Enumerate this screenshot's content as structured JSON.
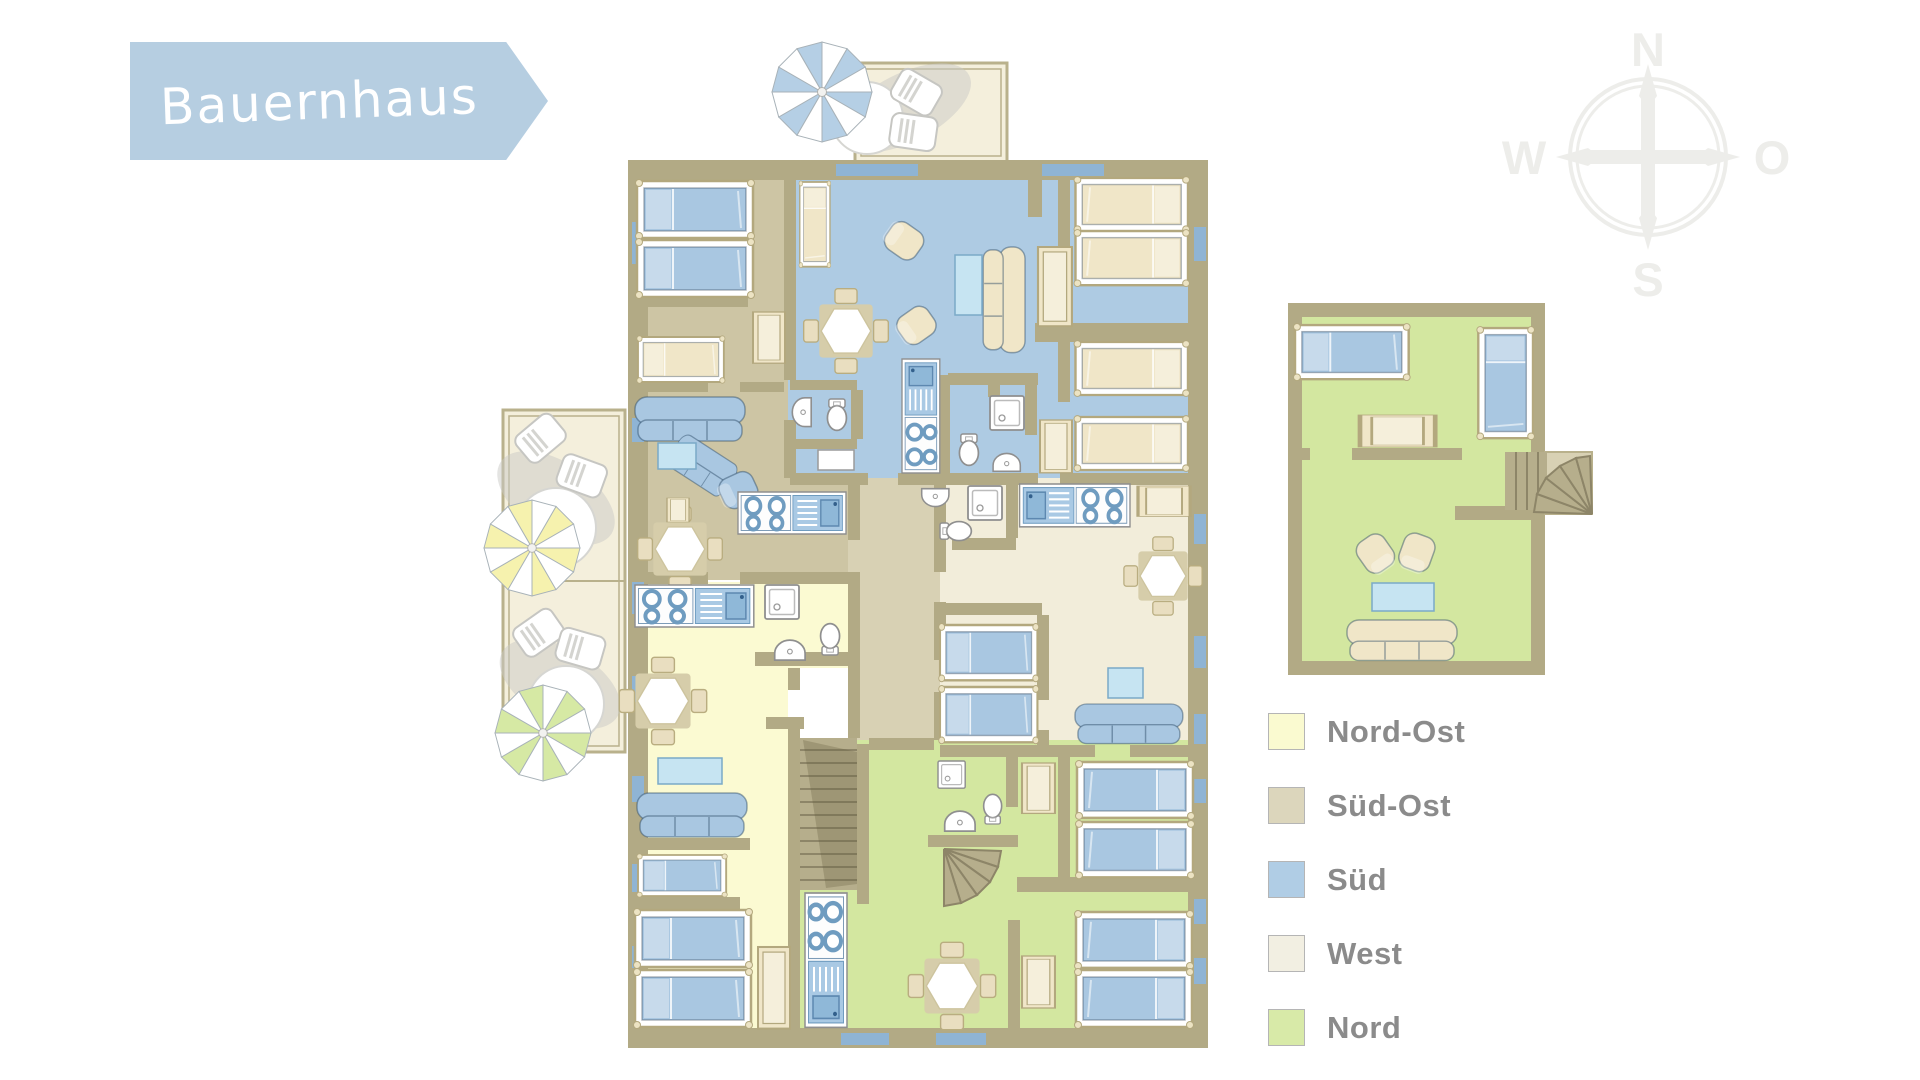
{
  "banner": {
    "title": "Bauernhaus"
  },
  "compass": {
    "north": "N",
    "east": "O",
    "south": "S",
    "west": "W"
  },
  "legend": {
    "items": [
      {
        "label": "Nord-Ost",
        "color": "#fafad0"
      },
      {
        "label": "Süd-Ost",
        "color": "#dcd6bc"
      },
      {
        "label": "Süd",
        "color": "#b0cde5"
      },
      {
        "label": "West",
        "color": "#f2efe2"
      },
      {
        "label": "Nord",
        "color": "#d8eaa8"
      }
    ]
  },
  "plan": {
    "colors": {
      "banner": "#b6cee1",
      "wall": "#b2aa85",
      "window": "#8fb4d4",
      "nordost": "#fbfad2",
      "suedost": "#cdc5a4",
      "sued": "#aecbe3",
      "west": "#f2edda",
      "nord": "#d3e7a0",
      "corridor": "#d8d1b4",
      "terrace": "#f4efdc",
      "terrace_border": "#b9b18c",
      "furn_blue": "#a9c7e1",
      "furn_cream": "#f0e6c8",
      "tv": "#c6e4f2",
      "stairs": "#b6ae8c",
      "stairs_line": "#8d8568",
      "shadow": "#c9c9c6",
      "compass": "#ededea",
      "umbrella_blue": "#b5cfe5",
      "umbrella_yellow": "#f6f2ae",
      "umbrella_green": "#d6e9a4"
    }
  }
}
